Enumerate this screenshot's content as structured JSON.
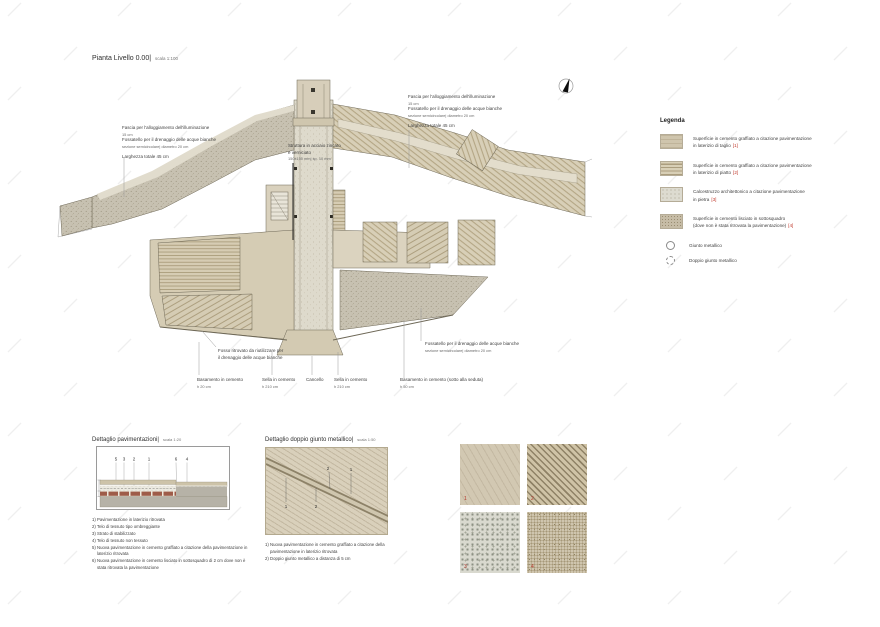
{
  "colors": {
    "red_ref": "#c0392b",
    "beige": "#d6ccb4",
    "gray_speckle": "#c7c1b1"
  },
  "title": {
    "main": "Pianta Livello 0.00|",
    "scale": "scala 1:100"
  },
  "annotations": {
    "fascia_left": {
      "l1": "Fascia per l'alloggiamento dell'illuminazione",
      "l2": "15 cm",
      "l3": "Fossatello per il drenaggio delle acque bianche",
      "l4": "sezione semicircolare| diametro 20 cm",
      "l5": "Larghezza totale 45 cm"
    },
    "fascia_right": {
      "l1": "Fascia per l'alloggiamento dell'illuminazione",
      "l2": "15 cm",
      "l3": "Fossatello per il drenaggio delle acque bianche",
      "l4": "sezione semicircolare| diametro 20 cm",
      "l5": "Larghezza totale 45 cm"
    },
    "struttura": {
      "l1": "Struttura in acciaio zincato",
      "l2": "e verniciato",
      "l3": "150x150 mm| sp. 10 mm"
    },
    "fossatello_sud": {
      "l1": "Fossatello per il drenaggio delle acque bianche",
      "l2": "sezione semicircolare| diametro 20 cm"
    },
    "fosso": {
      "l1": "Fosso ritrovato da riutilizzare per",
      "l2": "il drenaggio delle acque bianche"
    }
  },
  "bottom_labels": [
    {
      "label": "Basamento in cemento",
      "value": "h 20 cm"
    },
    {
      "label": "Sella in cemento",
      "value": "h 210 cm"
    },
    {
      "label": "Cancello",
      "value": ""
    },
    {
      "label": "Sella in cemento",
      "value": "h 210 cm"
    },
    {
      "label": "Basamento in cemento (sotto alla seduta)",
      "value": "h 50 cm"
    }
  ],
  "legend": {
    "title": "Legenda",
    "items": [
      {
        "line1": "Superficie in cemento graffiato a citazione pavimentazione",
        "line2": "in laterizio di taglio",
        "ref": "[1]"
      },
      {
        "line1": "Superficie in cemento graffiato a citazione pavimentazione",
        "line2": "in laterizio di piatto",
        "ref": "[2]"
      },
      {
        "line1": "Calcestruzzo architettonico a citazione pavimentazione",
        "line2": "in pietra",
        "ref": "[3]"
      },
      {
        "line1": "Superficie in cemento lisciato in sottosquadro",
        "line2": "(dove non è stata ritrovata la pavimentazione)",
        "ref": "[4]"
      }
    ],
    "symbols": [
      {
        "label": "Giunto metallico"
      },
      {
        "label": "Doppio giunto metallico"
      }
    ]
  },
  "detail_pavimentazioni": {
    "title": "Dettaglio pavimentazioni|",
    "scale": "scala 1:20",
    "callouts": [
      "5",
      "3",
      "2",
      "1",
      "6",
      "4"
    ],
    "notes": [
      "1) Pavimentazione in laterizio ritrovata",
      "2) Telo di tessuto tipo ombreggiante",
      "3) Strato di stabilizzato",
      "4) Telo di tessuto non tessuto",
      "5) Nuova pavimentazione in cemento graffiato a citazione della pavimentazione in laterizio ritrovata",
      "6) Nuova pavimentazione in cemento lisciato in sottosquadro di 2 cm dove non è stata ritrovata la pavimentazione"
    ]
  },
  "detail_giunto": {
    "title": "Dettaglio doppio giunto metallico|",
    "scale": "scala 1:50",
    "callouts": [
      "2",
      "1",
      "1",
      "2"
    ],
    "notes": [
      "1) Nuova pavimentazione in cemento graffiato a citazione della pavimentazione in laterizio ritrovata",
      "2) Doppio giunto metallico a distanza di 5 cm"
    ]
  },
  "samples": [
    {
      "num": "1"
    },
    {
      "num": "2"
    },
    {
      "num": "3"
    },
    {
      "num": "4"
    }
  ]
}
